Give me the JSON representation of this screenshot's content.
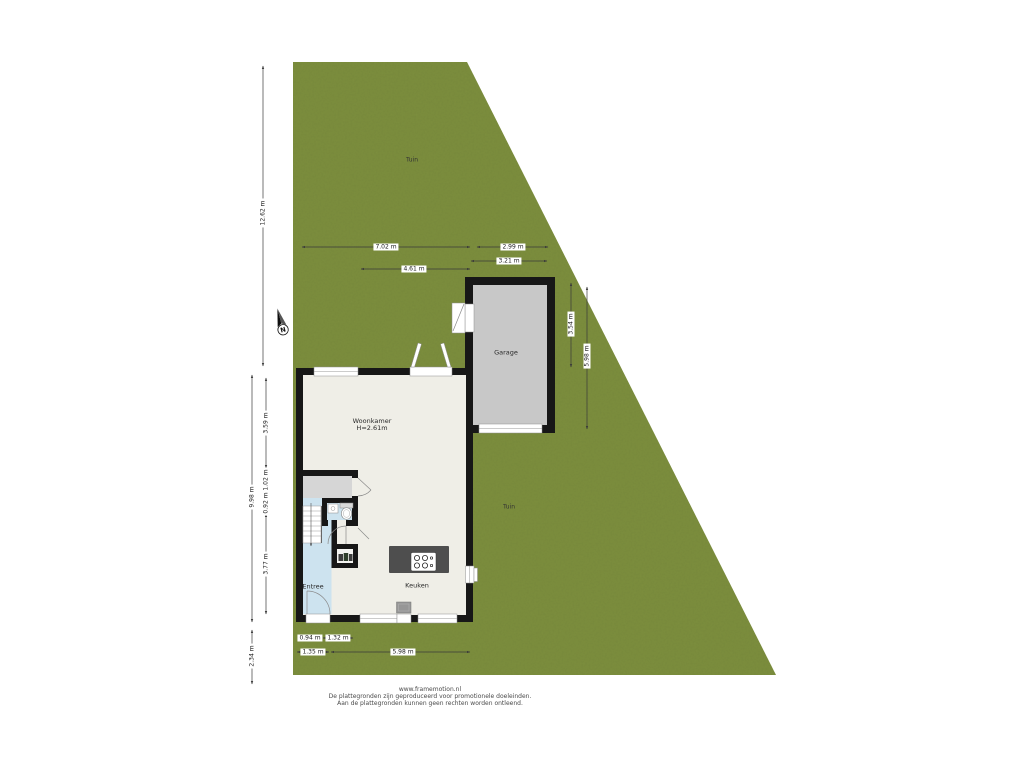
{
  "labels": {
    "tuin_top": "Tuin",
    "tuin_side": "Tuin",
    "woonkamer": "Woonkamer",
    "woonkamer_h": "H=2.61m",
    "garage": "Garage",
    "keuken": "Keuken",
    "entree": "Entree",
    "compass_n": "N"
  },
  "dimensions": {
    "garden_left": "12.62 m",
    "top_width_house": "7.02 m",
    "garage_width_inner": "2.99 m",
    "garage_width_outer": "3.21 m",
    "house_top_inner": "4.61 m",
    "garage_depth_inner": "3.54 m",
    "garage_depth_outer": "5.98 m",
    "house_left_outer": "9.98 m",
    "woonkamer_depth": "3.59 m",
    "left_seg2": "1.02 m",
    "left_seg3": "0.92 m",
    "keuken_depth": "3.77 m",
    "garden_below_house": "2.34 m",
    "bottom_seg1": "0.94 m",
    "bottom_seg2": "1.32 m",
    "bottom_outer1": "1.35 m",
    "bottom_outer2": "5.98 m"
  },
  "footer": {
    "line1": "www.framemotion.nl",
    "line2": "De plattegronden zijn geproduceerd voor promotionele doeleinden.",
    "line3": "Aan de plattegronden kunnen geen rechten worden ontleend."
  },
  "colors": {
    "garden": "#7D8F3E",
    "wall": "#171717",
    "floor": "#EFEEE7",
    "garage_floor": "#C8C8C8",
    "landing": "#D6D6D6",
    "wet_room": "#CDE3EF",
    "island": "#4E4E4E",
    "dim_text": "#1A1A1A",
    "footer_text": "#4A4A4A"
  }
}
